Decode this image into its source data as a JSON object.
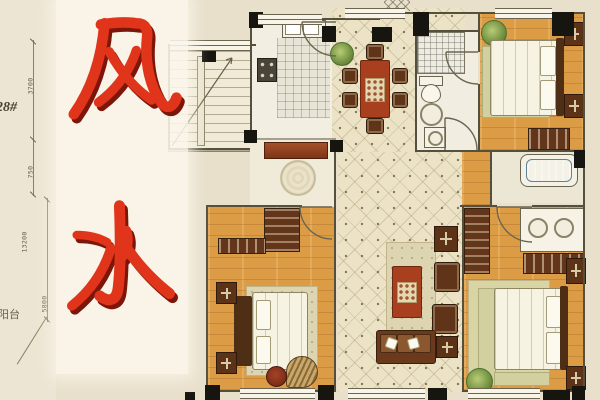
{
  "overlay": {
    "word": "风水",
    "characters": [
      "风",
      "水"
    ],
    "color": "#e0341b",
    "shadow_color": "#7c150a"
  },
  "annotations": {
    "building_label": "28#",
    "balcony_label": "阳台",
    "dimensions": {
      "top": "3700",
      "upper": "750",
      "middle": "13200",
      "lower": "5800"
    }
  },
  "palette": {
    "background": "#e8e0cb",
    "panel": "#faf6ea",
    "wood_floor": "#dc9c45",
    "tile_floor": "#ece3c6",
    "wall": "#55503e",
    "column": "#17150f",
    "dining_table_red": "#a8401f",
    "bathtub_blue": "#8fb9cc",
    "plant_green": "#7f9c4e"
  }
}
